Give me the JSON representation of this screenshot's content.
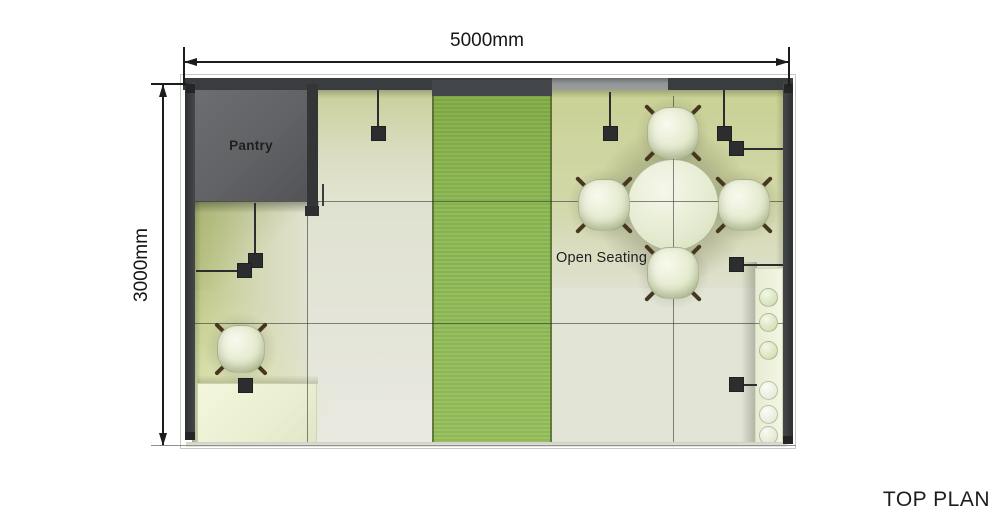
{
  "title": {
    "text": "TOP PLAN"
  },
  "dimensions": {
    "width": {
      "label": "5000mm"
    },
    "height": {
      "label": "3000mm"
    }
  },
  "rooms": {
    "pantry": {
      "label": "Pantry"
    },
    "open_seating": {
      "label": "Open Seating"
    }
  },
  "fixtures": {
    "dining_table": {
      "shape": "round",
      "chair_count": 4
    },
    "desk": {
      "chair_count": 1
    },
    "storage_cabinet": {
      "item_count": 6
    },
    "light_fixture_count": 9,
    "carpet_strip": {
      "color_name": "green"
    }
  },
  "palette": {
    "carpet-green": "#8cb852",
    "wall-dark": "#3a3d3f",
    "wall-light": "#929596",
    "pantry-gray": "#606265",
    "floor-cream": "#e4e5d7",
    "furniture-cream": "#eef2dc",
    "leg-brown": "#46371f",
    "line-dark": "#1c1c1c"
  }
}
